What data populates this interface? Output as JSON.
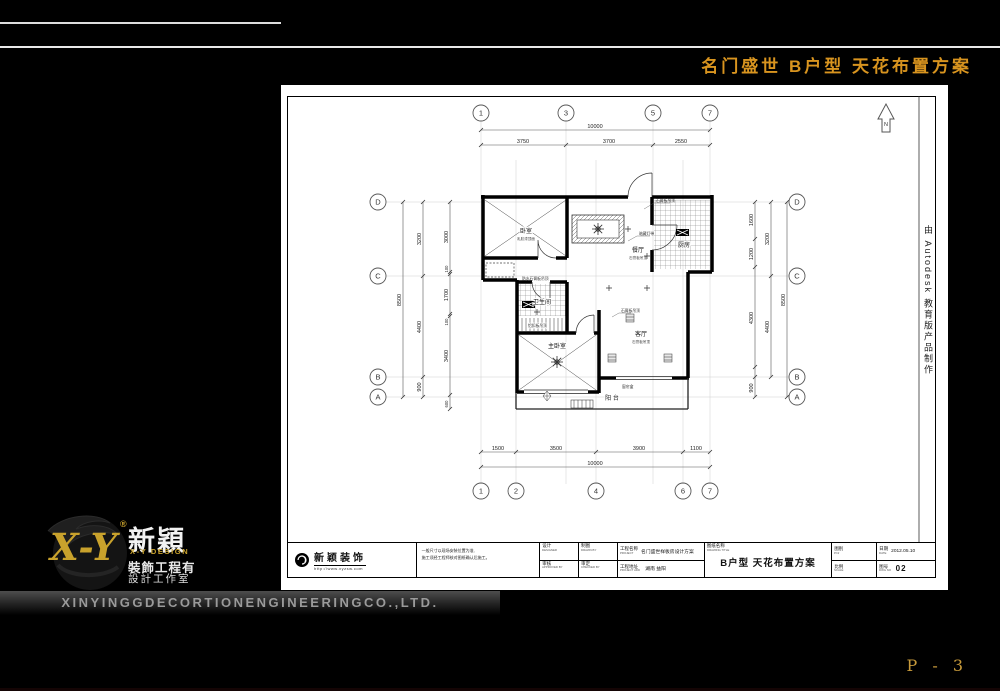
{
  "header": {
    "title": "名门盛世 B户型 天花布置方案",
    "page_no": "P - 3",
    "accent_color": "#d8941f"
  },
  "sidebar": {
    "brand_xy": "X-Y",
    "reg": "®",
    "brand_cn": "新穎",
    "brand_en": "X-Y DESIGN",
    "brand_line1": "裝飾工程有",
    "brand_line2": "設計工作室",
    "company_en": "XINYINGGDECORTIONENGINEERINGCO.,LTD."
  },
  "sheet": {
    "edu_note": "由 Autodesk 教育版产品制作",
    "north": "N",
    "rooms": {
      "bedroom": "卧室",
      "bedroom_note": "乳胶漆顶面",
      "dining": "餐厅",
      "dining_note": "石膏板吊顶",
      "kitchen": "厨房",
      "bath": "卫生间",
      "master": "主卧室",
      "living": "客厅",
      "living_note": "石膏板吊顶",
      "balcony": "阳 台"
    },
    "grid": {
      "top": [
        "1",
        "3",
        "5",
        "7"
      ],
      "bottom": [
        "1",
        "2",
        "4",
        "6",
        "7"
      ],
      "left": [
        "D",
        "C",
        "B",
        "A"
      ],
      "right": [
        "D",
        "C",
        "B",
        "A"
      ]
    },
    "dims": {
      "top_total": "10000",
      "top": [
        "3750",
        "3700",
        "2550"
      ],
      "bottom": [
        "1500",
        "3500",
        "3900",
        "1100"
      ],
      "bottom_total": "10000",
      "left_outer": "8500",
      "left_mid": [
        "3200",
        "4400",
        "900"
      ],
      "left_inner": [
        "3000",
        "100",
        "1700",
        "100",
        "3400",
        "600"
      ],
      "right_inner": [
        "1600",
        "1200",
        "4300",
        "900"
      ],
      "right_mid": [
        "3200",
        "4400"
      ],
      "right_outer": "8500"
    },
    "annotations": [
      "石膏板吊顶",
      "暗藏灯带",
      "防水石膏板吊顶",
      "石膏板吊顶",
      "窗帘盒",
      "铝扣板吊顶"
    ]
  },
  "titleblock": {
    "company": "新颖装饰",
    "url": "http://www.xyzsw.com",
    "note1": "一般尺寸以现场安装位置为准,",
    "note2": "施工须经工程师核对图纸确认后施工。",
    "f_design": "设计",
    "f_design_en": "DESIGNER",
    "f_draw": "制图",
    "f_draw_en": "DRAWN BY",
    "f_approve": "审核",
    "f_approve_en": "APPROVED BY",
    "f_check": "审定",
    "f_check_en": "CHECKED BY",
    "project_label": "工程名称",
    "project_en": "PROJECT",
    "project": "名门盛世样板房设计方案",
    "addr_label": "工程地址",
    "addr_en": "PROJECT ADD",
    "addr": "湖南 益阳",
    "dt_label": "图纸名称",
    "dt_en": "DRAWING TITLE",
    "drawing_title": "B户型 天花布置方案",
    "cat_label": "图别",
    "cat_en": "P.Nr",
    "scale_label": "比例",
    "scale_en": "SCALE",
    "date_label": "日期",
    "date_en": "DATE",
    "date": "2012.05.10",
    "no_label": "图号",
    "no_en": "DWG NO",
    "no": "02"
  }
}
